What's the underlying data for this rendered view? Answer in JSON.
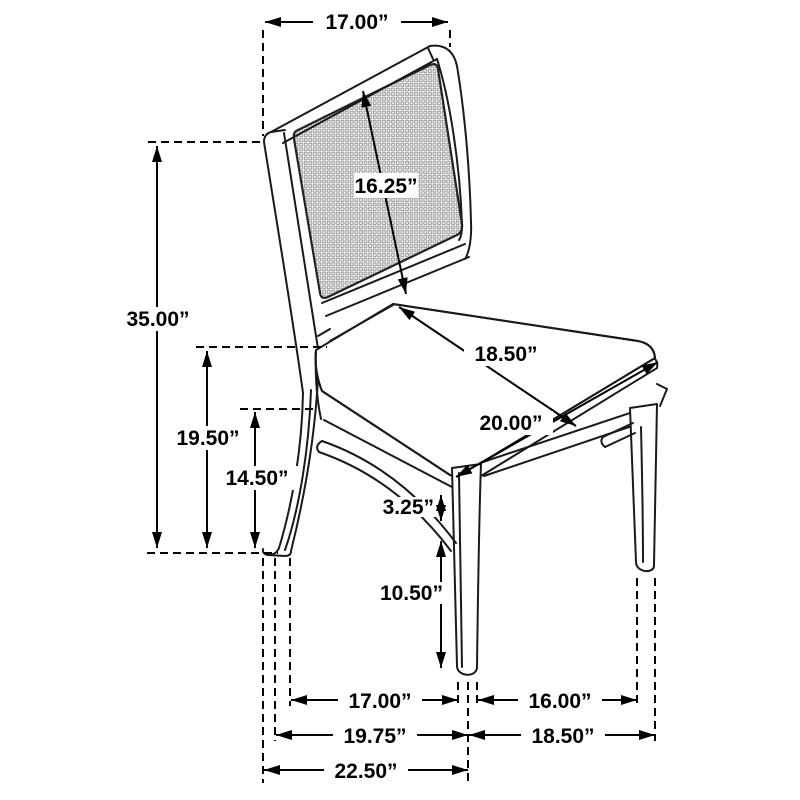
{
  "diagram": {
    "subject": "dining side chair with cane back and upholstered seat",
    "unit": "inches",
    "line_color": "#1a1a1a",
    "annotation_color": "#000000",
    "background_color": "#ffffff",
    "mesh_color": "#8c8c8c"
  },
  "dimensions": {
    "back_width": "17.00”",
    "back_diagonal": "16.25”",
    "overall_height": "35.00”",
    "seat_height": "19.50”",
    "underframe_height": "14.50”",
    "seat_diagonal_a": "18.50”",
    "seat_diagonal_b": "20.00”",
    "apron_thickness": "3.25”",
    "leg_height": "10.50”",
    "floor_front_span": "17.00”",
    "floor_side_span": "16.00”",
    "floor_depth": "19.75”",
    "floor_width": "18.50”",
    "overall_depth": "22.50”"
  }
}
